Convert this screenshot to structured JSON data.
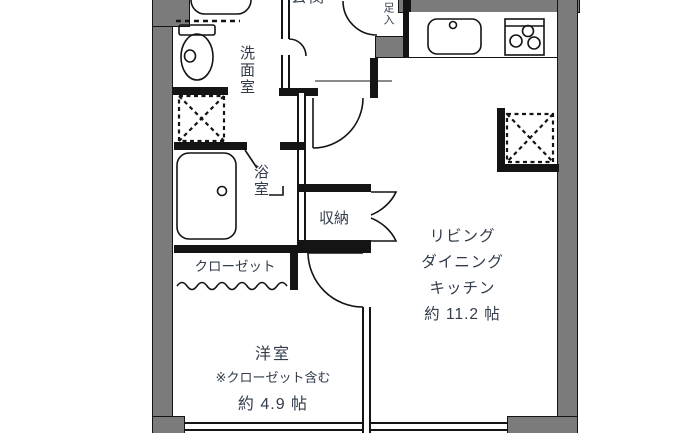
{
  "plan": {
    "type": "apartment-floor-plan",
    "rooms": {
      "living": {
        "line1": "リビング",
        "line2": "ダイニング",
        "line3": "キッチン",
        "size": "約 11.2 帖"
      },
      "western_room": {
        "name": "洋室",
        "note": "※クローゼット含む",
        "size": "約 4.9 帖"
      },
      "washroom": {
        "name": "洗面室"
      },
      "bathroom": {
        "name": "浴室"
      },
      "storage": {
        "name": "収納"
      },
      "closet": {
        "name": "クローゼット"
      },
      "entrance": {
        "name": "玄関"
      },
      "shoe_cabinet": {
        "name": "足入"
      }
    },
    "fixtures": [
      "toilet",
      "wash-basin-counter",
      "washing-machine-space",
      "bathtub",
      "kitchen-sink",
      "gas-stove",
      "refrigerator-space"
    ],
    "colors": {
      "wall_fill": "#7b7b7b",
      "line": "#141414",
      "text": "#323c4b",
      "background": "#ffffff"
    }
  }
}
